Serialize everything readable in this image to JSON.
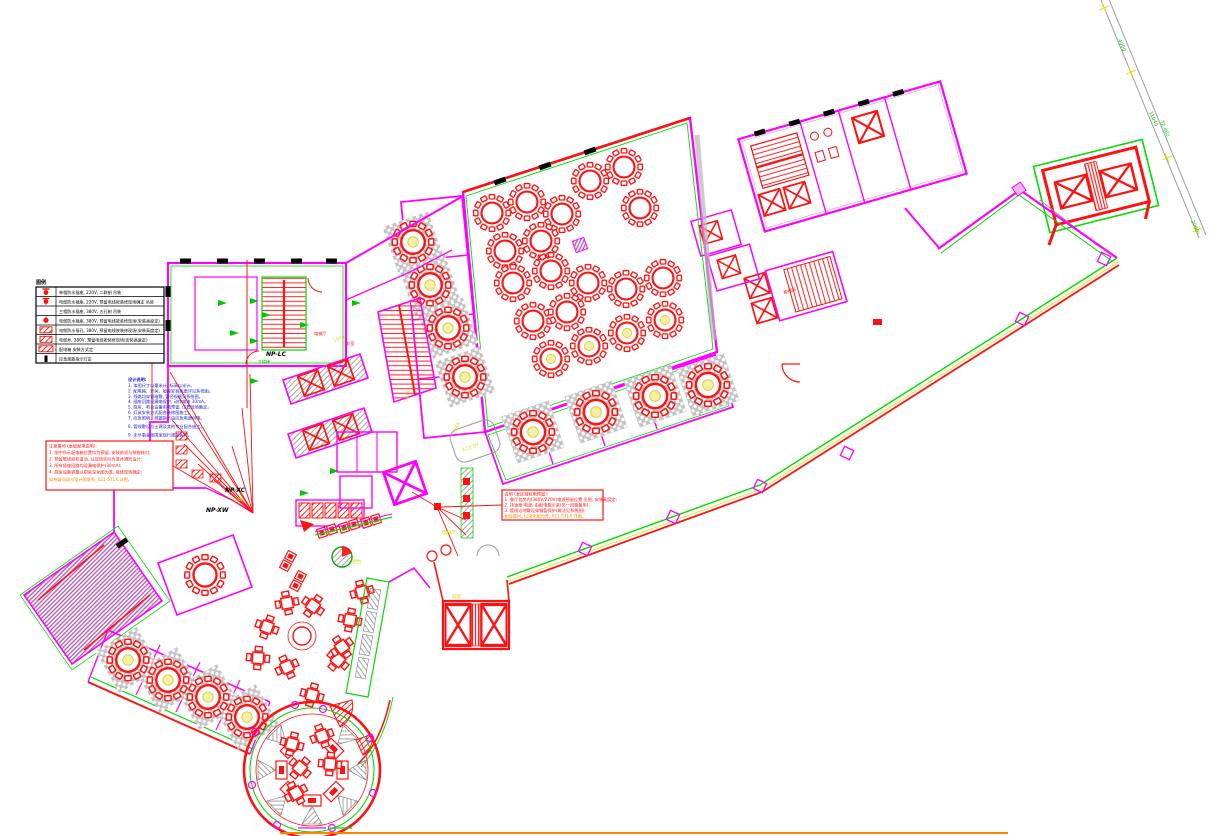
{
  "drawing": {
    "kind": "餐饮层电气平面图 (CAD)",
    "colors": {
      "wall": "#FF00FF",
      "trim": "#00DD00",
      "furniture": "#FF1111",
      "dim_text": "#D8D800",
      "notes_text": "#1818CC",
      "warning_text": "#FF1111",
      "highlight_text": "#FF8200",
      "road": "#A0A0A0",
      "window_mark": "#000000",
      "border_line": "#FF8200"
    }
  },
  "legend": {
    "title": "图例",
    "rows": [
      {
        "symbol": "socket-pin-icon",
        "label": "单相防水插座, 220V, 二联制  吊装"
      },
      {
        "symbol": "socket-pin-icon",
        "label": "电缆防水插座, 220V, 预留电线按装修现场确定  吊装"
      },
      {
        "symbol": "blank",
        "label": "三相防水插座, 380V, 五孔制  吊装"
      },
      {
        "symbol": "floor-socket-icon",
        "label": "电缆防水插座, 380V, 预留电线按装修现场(安装高度定)"
      },
      {
        "symbol": "cable-box-icon",
        "label": "电缆防水插孔, 380V, 预留电线按装修现场(安装高度定)"
      },
      {
        "symbol": "cable-box-icon",
        "label": "电缆井, 380V, 预留电线按装修现场(安装高度定)"
      },
      {
        "symbol": "panel-box-icon",
        "label": "配电箱  安装方式定"
      },
      {
        "symbol": "exit-light-icon",
        "label": "应急疏散指示灯定"
      }
    ]
  },
  "notes": {
    "title": "设计说明:",
    "lines": [
      "1. 本图尺寸以毫米计, 标高以米计。",
      "2. 配电箱、开关、插座安装高度详见系统图。",
      "3. 线路均穿管暗敷, 管径规格见系统图。",
      "4. 插座回路设漏电保护, 动作电流 30mA。",
      "5. 厨房、吧台设备用电预留, 位置现场确定。",
      "6. 灯具安装方式配合装修图施工。",
      "7. 应急照明、疏散指示由应急电源供电。",
      "8. 管线敷设与土建及其他专业配合施工。",
      "9. 未尽事宜按国家现行规范执行。"
    ]
  },
  "warn_left": {
    "lines": [
      "注意事项 (本层配电说明):",
      "1. 图中所示配电箱位置均为预留, 安装前须与装修核对;",
      "2. 预留管线如有变动, 以现场实际为准并通知设计;",
      "3. 所有插座回路均设漏电保护(30mA);",
      "4. 厨房设备容量以厨房深化图为准, 接线现场确定;"
    ],
    "tail": "如有疑问请与设计院联系, 021-571X 详图。"
  },
  "warn_mid": {
    "lines": [
      "说明 (本区域机电预留):",
      "1. 餐厅包房内(380V/220V)电源预留位置 见图, 安装高度定;",
      "2. 排油烟 电源, 由配电箱引来(另一回路备用);",
      "3. 管线沿地敷设穿钢管保护(做法见系统图);"
    ],
    "tail": "如有疑问, 以深化图为准, 021-571X 详图。"
  },
  "panels": {
    "np_lc": "NP-LC",
    "np_xc": "NP-XC",
    "np_xw": "NP-XW"
  },
  "rooms": {
    "lift_lobby_red": "电梯厅",
    "front_red": "前室",
    "stair_green": "主楼梯",
    "stair_ne": "楼梯间",
    "entry_hall": "入口门厅",
    "lift_lobby_yellow": "电梯厅",
    "front_yellow": "前室",
    "bar": "吧台"
  },
  "dims": {
    "d1500": "1500",
    "d3115": "3115",
    "d2344": "2344",
    "d1640": "1640"
  },
  "road": {
    "l1": "4000",
    "l2": "11040",
    "l3": "72.460",
    "l4": "2050"
  }
}
